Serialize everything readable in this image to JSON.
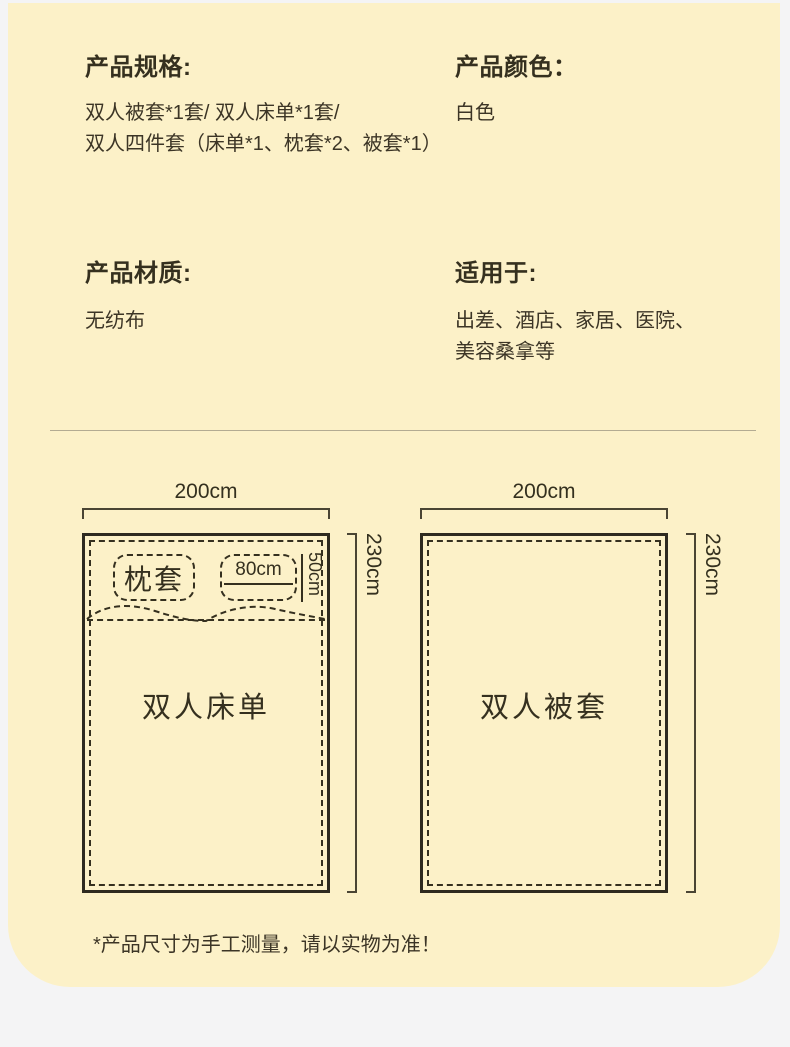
{
  "theme": {
    "page_background": "#f4f4f5",
    "card_background": "#fcf1c8",
    "text_color": "#3c3526",
    "line_color": "#2e2a1f",
    "divider_color": "#b3ab92"
  },
  "sections": {
    "spec": {
      "title": "产品规格:",
      "line1": "双人被套*1套/ 双人床单*1套/",
      "line2": "双人四件套（床单*1、枕套*2、被套*1）"
    },
    "color": {
      "title": "产品颜色：",
      "value": "白色"
    },
    "material": {
      "title": "产品材质:",
      "value": "无纺布"
    },
    "usage": {
      "title": "适用于:",
      "line1": "出差、酒店、家居、医院、",
      "line2": "美容桑拿等"
    }
  },
  "diagrams": {
    "sheet": {
      "width_label": "200cm",
      "height_label": "230cm",
      "name": "双人床单",
      "pillow_label": "枕套",
      "pillow_width_label": "80cm",
      "pillow_height_label": "50cm"
    },
    "duvet": {
      "width_label": "200cm",
      "height_label": "230cm",
      "name": "双人被套"
    }
  },
  "footer": {
    "note": "*产品尺寸为手工测量，请以实物为准！"
  }
}
